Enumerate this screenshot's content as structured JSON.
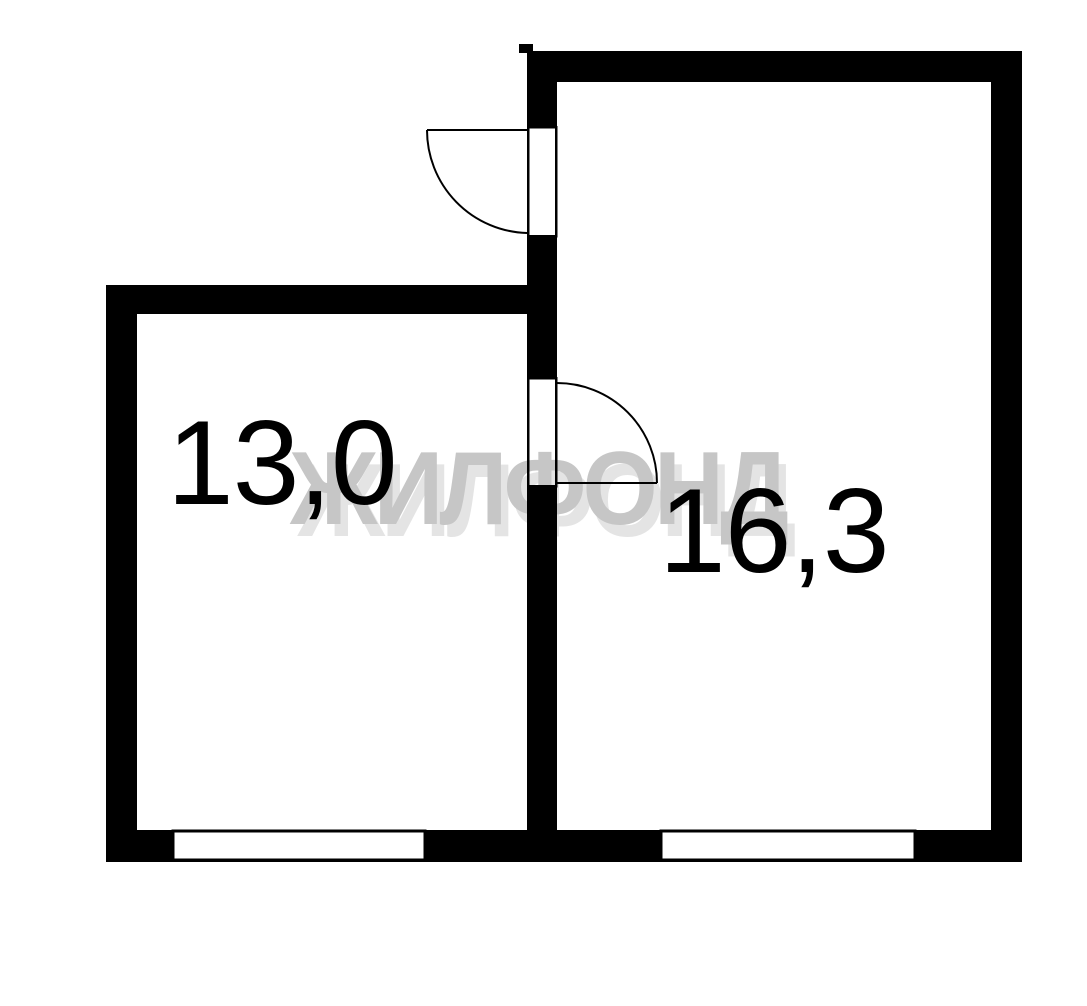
{
  "floorplan": {
    "rooms": [
      {
        "id": "left-room",
        "area_label": "13,0"
      },
      {
        "id": "right-room",
        "area_label": "16,3"
      }
    ],
    "watermark": {
      "text": "ЖИЛФОНД",
      "color": "#c6c6c6",
      "shadow_color": "#e4e4e4"
    },
    "colors": {
      "wall": "#000000",
      "background": "#ffffff"
    }
  }
}
